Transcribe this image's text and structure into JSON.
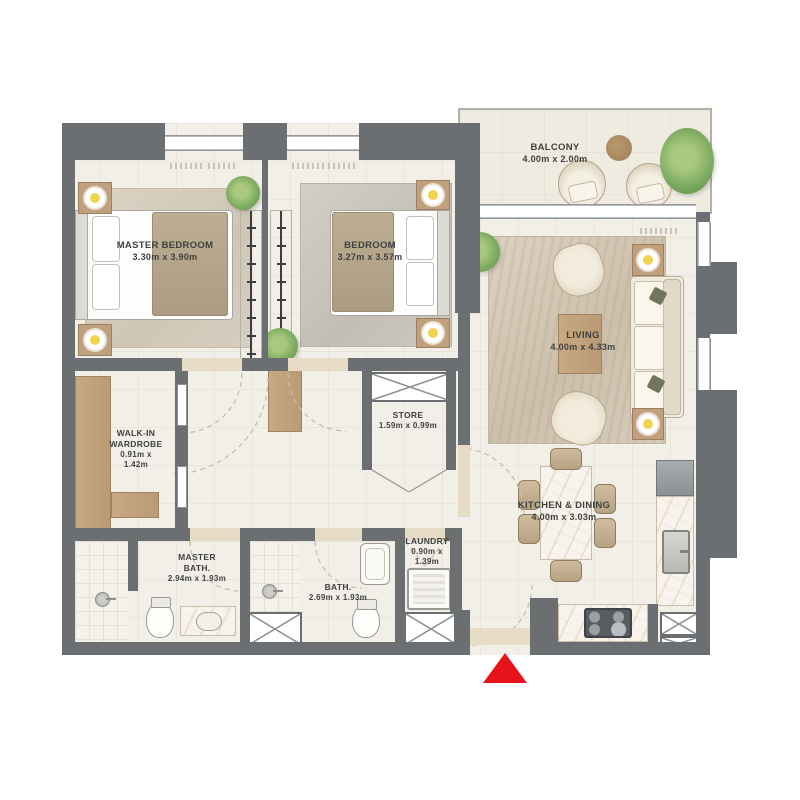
{
  "plan": {
    "title": "2 bedroom apartment floor plan",
    "rooms": {
      "master_bedroom": {
        "name": "MASTER BEDROOM",
        "dims": "3.30m x 3.90m"
      },
      "bedroom": {
        "name": "BEDROOM",
        "dims": "3.27m x 3.57m"
      },
      "balcony": {
        "name": "BALCONY",
        "dims": "4.00m x 2.00m"
      },
      "living": {
        "name": "LIVING",
        "dims": "4.00m x 4.33m"
      },
      "kitchen_dining": {
        "name": "KITCHEN & DINING",
        "dims": "4.00m x 3.03m"
      },
      "walk_in_wardrobe": {
        "name": "WALK-IN WARDROBE",
        "dims": "0.91m x 1.42m"
      },
      "store": {
        "name": "STORE",
        "dims": "1.59m x 0.99m"
      },
      "master_bath": {
        "name": "MASTER BATH.",
        "dims": "2.94m x 1.93m"
      },
      "bath": {
        "name": "BATH.",
        "dims": "2.69m x 1.93m"
      },
      "laundry": {
        "name": "LAUNDRY",
        "dims": "0.90m x 1.39m"
      }
    },
    "entrance_marker": {
      "icon": "entrance-arrow",
      "color": "#e8121a"
    },
    "colors": {
      "wall": "#6c6f71",
      "floor": "#f2efe8",
      "balcony_floor": "#f0ebe1",
      "wood": "#c0a07d",
      "rug": "#d8cfc1",
      "lamp": "#f0d44e",
      "plant": "#7dab61",
      "red": "#e8121a",
      "marble": "#f8f4ed",
      "text": "#3f4040"
    }
  }
}
